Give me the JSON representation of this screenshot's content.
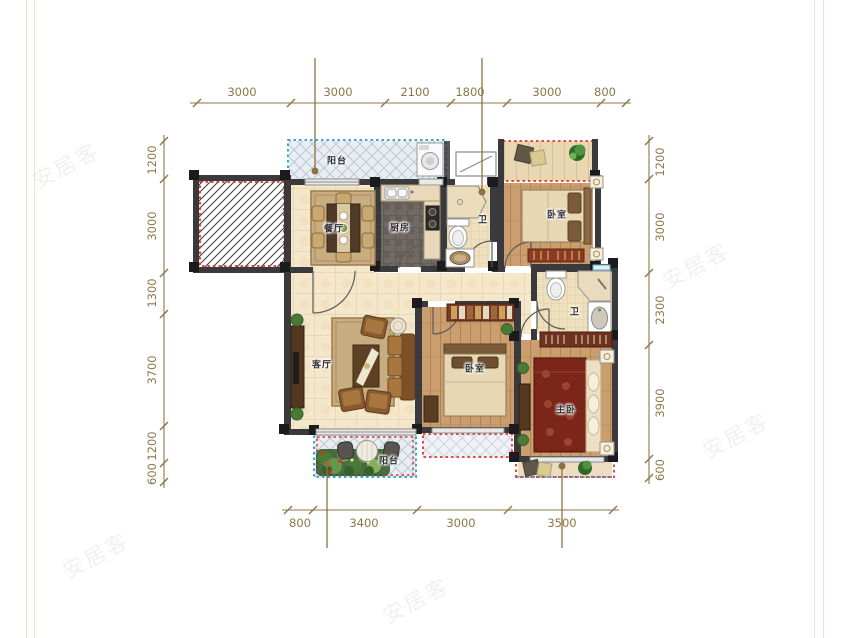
{
  "watermark": {
    "text": "安居客"
  },
  "room_labels": [
    {
      "id": "balcony-top",
      "text": "阳台"
    },
    {
      "id": "dining",
      "text": "餐厅"
    },
    {
      "id": "kitchen",
      "text": "厨房"
    },
    {
      "id": "bath-1",
      "text": "卫"
    },
    {
      "id": "bedroom-top-right",
      "text": "卧室"
    },
    {
      "id": "living",
      "text": "客厅"
    },
    {
      "id": "bedroom-middle",
      "text": "卧室"
    },
    {
      "id": "bath-2",
      "text": "卫"
    },
    {
      "id": "master-bedroom",
      "text": "主卧"
    },
    {
      "id": "balcony-bottom",
      "text": "阳台"
    }
  ],
  "dimensions": {
    "top": [
      "3000",
      "3000",
      "2100",
      "1800",
      "3000",
      "800"
    ],
    "left": [
      "1200",
      "3000",
      "1300",
      "3700",
      "1200",
      "600"
    ],
    "right": [
      "1200",
      "3000",
      "2300",
      "3900",
      "600"
    ],
    "bottom": [
      "800",
      "3400",
      "3000",
      "3500"
    ]
  },
  "colors": {
    "dimension": "#8d7748",
    "wall": "#3a3a3d",
    "red_dotted": "#e6322c",
    "cyan_dotted": "#36a6d8",
    "tile_floor": "#f4e7ca",
    "wood_floor": "#cb9e6f"
  }
}
